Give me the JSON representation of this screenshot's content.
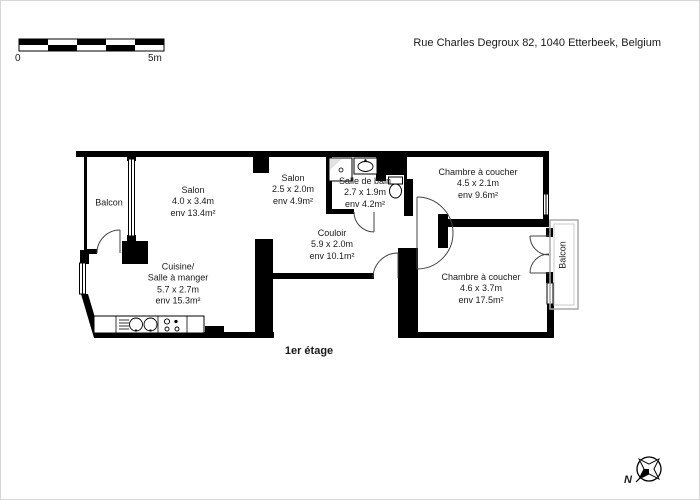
{
  "header": {
    "address": "Rue Charles Degroux 82, 1040 Etterbeek, Belgium"
  },
  "scale_bar": {
    "start_label": "0",
    "end_label": "5m"
  },
  "floor_label": "1er étage",
  "compass": {
    "north_label": "N",
    "icon": "compass-rose-icon"
  },
  "colors": {
    "wall": "#000000",
    "background": "#ffffff",
    "balcony_outline": "#aaaaaa"
  },
  "rooms": {
    "balcony_left": {
      "name": "Balcon"
    },
    "living_room": {
      "name": "Salon",
      "dims": "4.0 x 3.4m",
      "area": "env 13.4m²"
    },
    "salon_small": {
      "name": "Salon",
      "dims": "2.5 x 2.0m",
      "area": "env 4.9m²"
    },
    "bathroom": {
      "name": "Salle de bain",
      "dims": "2.7 x 1.9m",
      "area": "env 4.2m²"
    },
    "bedroom_top": {
      "name": "Chambre à coucher",
      "dims": "4.5 x 2.1m",
      "area": "env 9.6m²"
    },
    "hallway": {
      "name": "Couloir",
      "dims": "5.9 x 2.0m",
      "area": "env 10.1m²"
    },
    "kitchen": {
      "name": "Cuisine/\nSalle à manger",
      "dims": "5.7 x 2.7m",
      "area": "env 15.3m²"
    },
    "bedroom_bottom": {
      "name": "Chambre à coucher",
      "dims": "4.6 x 3.7m",
      "area": "env 17.5m²"
    },
    "balcony_right": {
      "name": "Balcon"
    }
  }
}
